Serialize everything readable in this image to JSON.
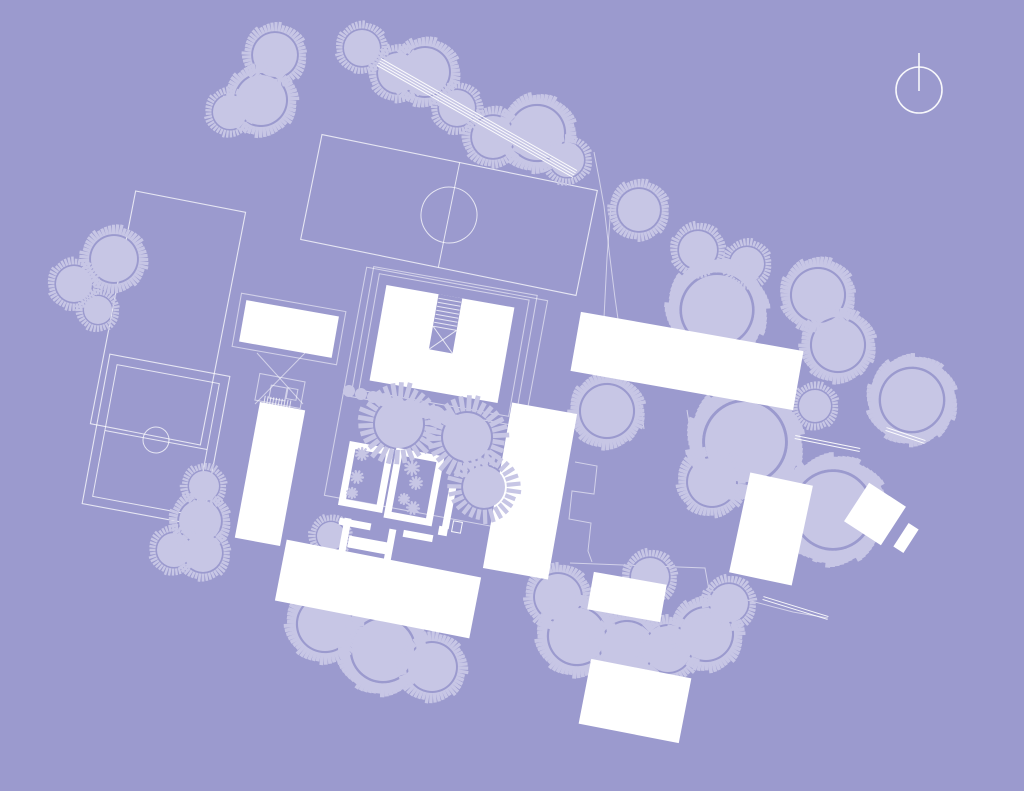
{
  "scene": {
    "width": 1024,
    "height": 791
  },
  "colors": {
    "background": "#9b9ace",
    "vegetation": "#c7c6e5",
    "building": "#ffffff",
    "line_strong": "rgba(255,255,255,0.92)",
    "line": "rgba(255,255,255,0.75)",
    "line_faint": "rgba(255,255,255,0.55)"
  },
  "north_arrow": {
    "cx": 919,
    "cy": 90,
    "r": 23,
    "tail": [
      919,
      53,
      919,
      91
    ]
  },
  "sports_field": {
    "cx": 449,
    "cy": 215,
    "w": 281,
    "h": 107,
    "rot": 11.5,
    "circle_r": 28,
    "midline": true
  },
  "court": {
    "cx": 156,
    "cy": 440,
    "w": 122,
    "h": 152,
    "rot": 10.5,
    "inset": 9,
    "circle_r": 13,
    "midline": true
  },
  "parcel": {
    "cx": 168,
    "cy": 318,
    "w": 112,
    "h": 237,
    "rot": 11
  },
  "outline_rects": [
    {
      "cx": 444,
      "cy": 345,
      "w": 152,
      "h": 118,
      "rot": 10
    },
    {
      "cx": 444,
      "cy": 346,
      "w": 166,
      "h": 132,
      "rot": 10
    },
    {
      "cx": 436,
      "cy": 398,
      "w": 184,
      "h": 232,
      "rot": 10.5
    },
    {
      "cx": 289,
      "cy": 329,
      "w": 106,
      "h": 54,
      "rot": 10
    },
    {
      "cx": 280,
      "cy": 391,
      "w": 46,
      "h": 27,
      "rot": 10.5
    },
    {
      "cx": 278,
      "cy": 393,
      "w": 16,
      "h": 13,
      "rot": 10.5
    },
    {
      "cx": 292,
      "cy": 394,
      "w": 10,
      "h": 11,
      "rot": 10.5
    }
  ],
  "boundary_lines": [
    [
      [
        594,
        152
      ],
      [
        599,
        178
      ],
      [
        604,
        206
      ],
      [
        609,
        250
      ],
      [
        615,
        298
      ],
      [
        619,
        326
      ]
    ],
    [
      [
        611,
        206
      ],
      [
        607,
        258
      ],
      [
        604,
        318
      ]
    ],
    [
      [
        575,
        462
      ],
      [
        597,
        466
      ],
      [
        594,
        494
      ],
      [
        572,
        491
      ],
      [
        569,
        519
      ],
      [
        591,
        523
      ],
      [
        588,
        551
      ],
      [
        592,
        562
      ]
    ],
    [
      [
        570,
        563
      ],
      [
        705,
        568
      ],
      [
        709,
        590
      ],
      [
        793,
        612
      ],
      [
        828,
        618
      ]
    ],
    [
      [
        640,
        400
      ],
      [
        644,
        429
      ]
    ],
    [
      [
        687,
        410
      ],
      [
        693,
        448
      ],
      [
        729,
        460
      ]
    ],
    [
      [
        720,
        452
      ],
      [
        726,
        470
      ],
      [
        731,
        485
      ]
    ]
  ],
  "footpaths": [
    {
      "x1": 379,
      "y1": 62,
      "x2": 575,
      "y2": 174,
      "n": 4,
      "gap": 2.6
    },
    {
      "x1": 795,
      "y1": 437,
      "x2": 860,
      "y2": 450,
      "n": 2,
      "gap": 3
    },
    {
      "x1": 886,
      "y1": 429,
      "x2": 925,
      "y2": 442,
      "n": 2,
      "gap": 3
    },
    {
      "x1": 763,
      "y1": 598,
      "x2": 828,
      "y2": 618,
      "n": 2,
      "gap": 3
    }
  ],
  "trees": [
    [
      275,
      55,
      22
    ],
    [
      261,
      100,
      25
    ],
    [
      230,
      112,
      17
    ],
    [
      362,
      48,
      18
    ],
    [
      398,
      73,
      20
    ],
    [
      425,
      72,
      24
    ],
    [
      457,
      108,
      18
    ],
    [
      493,
      137,
      21
    ],
    [
      537,
      133,
      27
    ],
    [
      567,
      160,
      17
    ],
    [
      114,
      259,
      23
    ],
    [
      74,
      284,
      18
    ],
    [
      98,
      310,
      14
    ],
    [
      204,
      486,
      15
    ],
    [
      200,
      521,
      21
    ],
    [
      174,
      550,
      17
    ],
    [
      203,
      553,
      19
    ],
    [
      331,
      536,
      14
    ],
    [
      325,
      624,
      27
    ],
    [
      383,
      650,
      31
    ],
    [
      432,
      667,
      24
    ],
    [
      558,
      597,
      23
    ],
    [
      577,
      636,
      28
    ],
    [
      627,
      648,
      26
    ],
    [
      668,
      649,
      23
    ],
    [
      706,
      634,
      26
    ],
    [
      729,
      603,
      19
    ],
    [
      650,
      577,
      19
    ],
    [
      639,
      210,
      21
    ],
    [
      698,
      250,
      19
    ],
    [
      747,
      264,
      17
    ],
    [
      717,
      310,
      35
    ],
    [
      818,
      295,
      26
    ],
    [
      838,
      345,
      26
    ],
    [
      912,
      400,
      31
    ],
    [
      607,
      411,
      26
    ],
    [
      815,
      406,
      16
    ],
    [
      745,
      442,
      40
    ],
    [
      712,
      482,
      24
    ],
    [
      833,
      510,
      38
    ]
  ],
  "thick_trees": [
    [
      399,
      424,
      24
    ],
    [
      467,
      437,
      24
    ],
    [
      484,
      487,
      21
    ]
  ],
  "bushes": [
    [
      349,
      391,
      6
    ],
    [
      361,
      394,
      6
    ],
    [
      373,
      397,
      6
    ],
    [
      385,
      400,
      7
    ],
    [
      397,
      403,
      7
    ],
    [
      410,
      406,
      7
    ],
    [
      423,
      410,
      8
    ],
    [
      436,
      414,
      8
    ],
    [
      448,
      418,
      8
    ]
  ],
  "plants": [
    [
      362,
      454,
      6
    ],
    [
      357,
      477,
      6
    ],
    [
      352,
      493,
      5
    ],
    [
      412,
      468,
      7
    ],
    [
      416,
      483,
      6
    ],
    [
      404,
      499,
      5
    ],
    [
      413,
      508,
      6
    ]
  ],
  "buildings": [
    {
      "cx": 289,
      "cy": 329,
      "w": 94,
      "h": 42,
      "rot": 10
    },
    {
      "cx": 442,
      "cy": 344,
      "w": 130,
      "h": 97,
      "rot": 10,
      "notch": {
        "w": 24,
        "d": 56,
        "stairs": 8
      }
    },
    {
      "cx": 270,
      "cy": 474,
      "w": 46,
      "h": 138,
      "rot": 10.5
    },
    {
      "cx": 378,
      "cy": 589,
      "w": 198,
      "h": 62,
      "rot": 11
    },
    {
      "cx": 530,
      "cy": 491,
      "w": 66,
      "h": 168,
      "rot": 10
    },
    {
      "cx": 687,
      "cy": 361,
      "w": 226,
      "h": 60,
      "rot": 10
    },
    {
      "cx": 627,
      "cy": 597,
      "w": 74,
      "h": 38,
      "rot": 10
    },
    {
      "cx": 635,
      "cy": 701,
      "w": 102,
      "h": 66,
      "rot": 11
    },
    {
      "cx": 771,
      "cy": 529,
      "w": 64,
      "h": 102,
      "rot": 12
    },
    {
      "cx": 875,
      "cy": 514,
      "w": 44,
      "h": 46,
      "rot": 33
    },
    {
      "cx": 906,
      "cy": 538,
      "w": 12,
      "h": 28,
      "rot": 33
    }
  ],
  "wall_rooms": [
    {
      "cx": 366,
      "cy": 477,
      "w": 38,
      "h": 58,
      "rot": 10.5,
      "stroke": 7
    },
    {
      "cx": 414,
      "cy": 487,
      "w": 42,
      "h": 64,
      "rot": 10.5,
      "stroke": 7
    }
  ],
  "wall_segments": [
    [
      355,
      524,
      32,
      7
    ],
    [
      345,
      535,
      7,
      34
    ],
    [
      368,
      545,
      40,
      12
    ],
    [
      390,
      545,
      7,
      32
    ],
    [
      418,
      536,
      30,
      7
    ],
    [
      443,
      531,
      9,
      9
    ],
    [
      449,
      508,
      7,
      42
    ]
  ],
  "door_outlines": [
    {
      "cx": 457,
      "cy": 527,
      "w": 9,
      "h": 11,
      "rot": 10.5
    }
  ],
  "x_braces": [
    [
      257,
      353,
      303,
      404
    ],
    [
      305,
      353,
      255,
      404
    ]
  ],
  "stair_hatches": [
    {
      "cx": 277,
      "cy": 404,
      "w": 26,
      "h": 12,
      "rot": 10.5,
      "n": 9
    }
  ]
}
